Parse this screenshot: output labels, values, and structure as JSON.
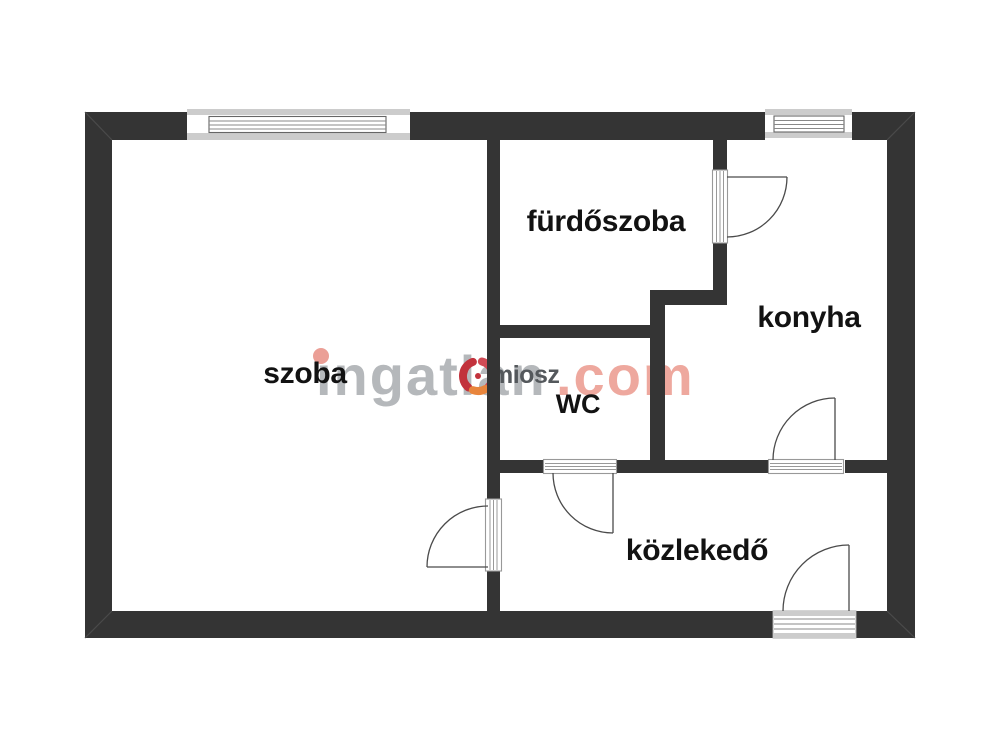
{
  "floorplan": {
    "rooms": [
      {
        "id": "szoba",
        "label": "szoba"
      },
      {
        "id": "furdoszoba",
        "label": "fürdőszoba"
      },
      {
        "id": "konyha",
        "label": "konyha"
      },
      {
        "id": "wc",
        "label": "WC"
      },
      {
        "id": "kozlekedo",
        "label": "közlekedő"
      }
    ],
    "window_count": 2,
    "door_count": 5
  },
  "watermark": {
    "brand_prefix": "ingatlan",
    "brand_suffix": ".com",
    "association": "miosz",
    "logo": "ingatlan-com-swirl-logo"
  },
  "colors": {
    "background": "#ffffff",
    "wall": "#343434",
    "window_band_gray": "#cccccc",
    "frame_gray": "#999999",
    "door_line": "#4a4a4a",
    "label_text": "#121212",
    "watermark_gray": "#b5b8bb",
    "watermark_salmon": "#eea89e",
    "association_text": "#54585c",
    "logo_red": "#c2323c",
    "logo_orange": "#e8853c"
  }
}
